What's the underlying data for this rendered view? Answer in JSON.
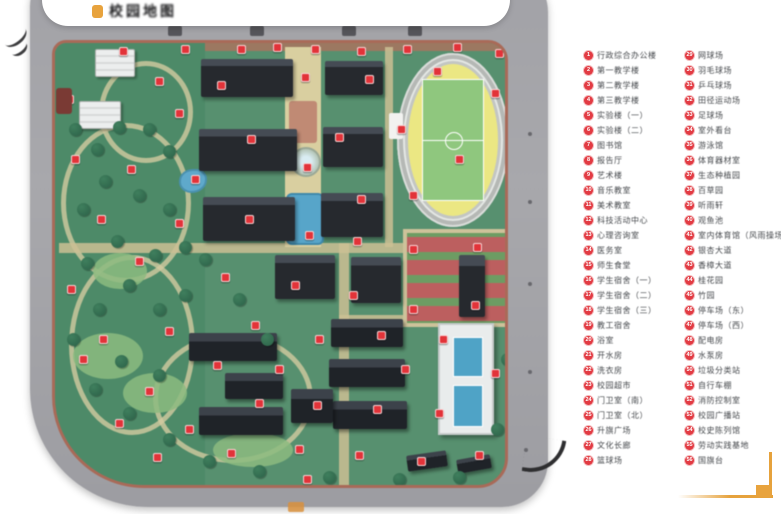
{
  "window": {
    "width": 781,
    "height": 514
  },
  "banner": {
    "logo_text": "校园地图",
    "logo_color": "#e8a33d"
  },
  "colors": {
    "legend_marker_red": "#e23b43",
    "accent_gold": "#e6a23c",
    "road_gray": "#a6a6aa",
    "campus_green": "#57906f",
    "boundary_redbrown": "#a96a58",
    "pond_blue": "#5fa9cb",
    "track_yellow": "#ebe783",
    "field_green": "#8fc77e",
    "court_red": "#bc5f5f",
    "roof_dark": "#26292e"
  },
  "map": {
    "features": [
      "ring-road",
      "campus-boundary",
      "running-track-stadium",
      "soccer-field",
      "teaching-buildings",
      "dormitory-buildings",
      "white-roof-buildings",
      "central-axis-plaza",
      "fountain",
      "axis-pool",
      "garden-pond",
      "winding-garden-paths",
      "sports-courts",
      "swimming-hall",
      "location-markers",
      "trees",
      "south-gate"
    ]
  },
  "legend": {
    "columns": [
      {
        "items": [
          {
            "num": "1",
            "label": "行政综合办公楼"
          },
          {
            "num": "2",
            "label": "第一教学楼"
          },
          {
            "num": "3",
            "label": "第二教学楼"
          },
          {
            "num": "4",
            "label": "第三教学楼"
          },
          {
            "num": "5",
            "label": "实验楼（一）"
          },
          {
            "num": "6",
            "label": "实验楼（二）"
          },
          {
            "num": "7",
            "label": "图书馆"
          },
          {
            "num": "8",
            "label": "报告厅"
          },
          {
            "num": "9",
            "label": "艺术楼"
          },
          {
            "num": "10",
            "label": "音乐教室"
          },
          {
            "num": "11",
            "label": "美术教室"
          },
          {
            "num": "12",
            "label": "科技活动中心"
          },
          {
            "num": "13",
            "label": "心理咨询室"
          },
          {
            "num": "14",
            "label": "医务室"
          },
          {
            "num": "15",
            "label": "师生食堂"
          },
          {
            "num": "16",
            "label": "学生宿舍（一）"
          },
          {
            "num": "17",
            "label": "学生宿舍（二）"
          },
          {
            "num": "18",
            "label": "学生宿舍（三）"
          },
          {
            "num": "19",
            "label": "教工宿舍"
          },
          {
            "num": "20",
            "label": "浴室"
          },
          {
            "num": "21",
            "label": "开水房"
          },
          {
            "num": "22",
            "label": "洗衣房"
          },
          {
            "num": "23",
            "label": "校园超市"
          },
          {
            "num": "24",
            "label": "门卫室（南）"
          },
          {
            "num": "25",
            "label": "门卫室（北）"
          },
          {
            "num": "26",
            "label": "升旗广场"
          },
          {
            "num": "27",
            "label": "文化长廊"
          },
          {
            "num": "28",
            "label": "篮球场"
          }
        ]
      },
      {
        "items": [
          {
            "num": "29",
            "label": "网球场"
          },
          {
            "num": "30",
            "label": "羽毛球场"
          },
          {
            "num": "31",
            "label": "乒乓球场"
          },
          {
            "num": "32",
            "label": "田径运动场"
          },
          {
            "num": "33",
            "label": "足球场"
          },
          {
            "num": "34",
            "label": "室外看台"
          },
          {
            "num": "35",
            "label": "游泳馆"
          },
          {
            "num": "36",
            "label": "体育器材室"
          },
          {
            "num": "37",
            "label": "生态种植园"
          },
          {
            "num": "38",
            "label": "百草园"
          },
          {
            "num": "39",
            "label": "听雨轩"
          },
          {
            "num": "40",
            "label": "观鱼池"
          },
          {
            "num": "41",
            "label": "室内体育馆（风雨操场）"
          },
          {
            "num": "42",
            "label": "银杏大道"
          },
          {
            "num": "43",
            "label": "香樟大道"
          },
          {
            "num": "44",
            "label": "桂花园"
          },
          {
            "num": "45",
            "label": "竹园"
          },
          {
            "num": "46",
            "label": "停车场（东）"
          },
          {
            "num": "47",
            "label": "停车场（西）"
          },
          {
            "num": "48",
            "label": "配电房"
          },
          {
            "num": "49",
            "label": "水泵房"
          },
          {
            "num": "50",
            "label": "垃圾分类站"
          },
          {
            "num": "51",
            "label": "自行车棚"
          },
          {
            "num": "52",
            "label": "消防控制室"
          },
          {
            "num": "53",
            "label": "校园广播站"
          },
          {
            "num": "54",
            "label": "校史陈列馆"
          },
          {
            "num": "55",
            "label": "劳动实践基地"
          },
          {
            "num": "56",
            "label": "国旗台"
          }
        ]
      }
    ]
  }
}
